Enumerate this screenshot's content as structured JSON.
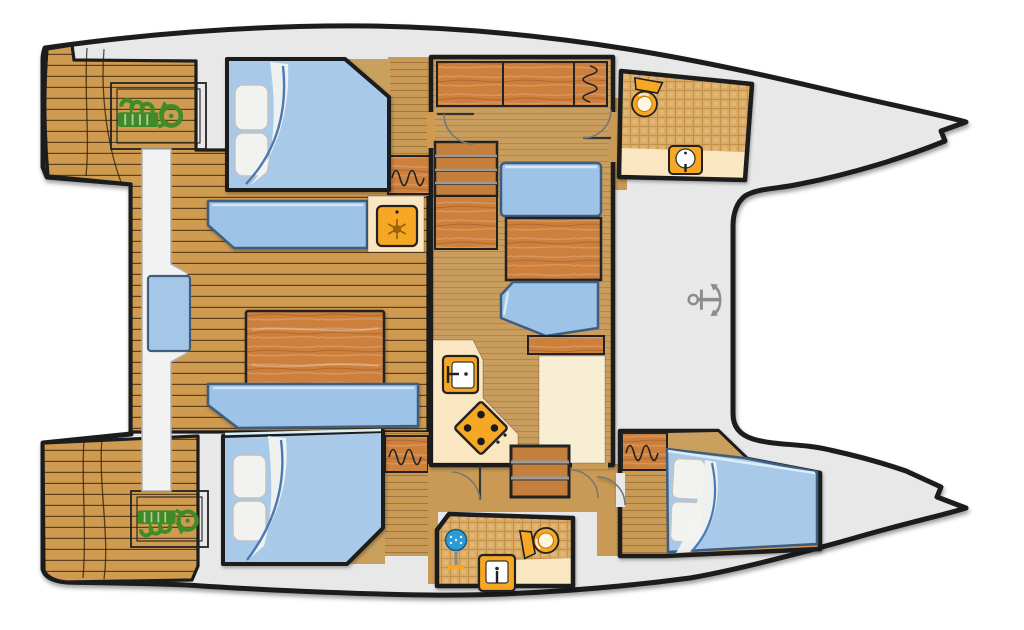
{
  "title": "Catamaran yacht deck floor plan",
  "colors": {
    "page_bg": "#ffffff",
    "hull_fill": "#e8e8e8",
    "outline": "#1c1c1c",
    "deck_wood": "#cf9b51",
    "deck_line": "#4a3110",
    "floor_wood": "#c99a55",
    "floor_plain": "#c89a55",
    "salon_wood": "#c99d5e",
    "cabinet_wood": "#cd7f3c",
    "step_wood": "#c57f3d",
    "bed_blue": "#a9c9e9",
    "bed_edge": "#3f5e7e",
    "bed_highlight": "#d8effa",
    "bench_blue": "#9dc3e8",
    "cushion_blue": "#a5c6e7",
    "pillow_white": "#f2f2f0",
    "sheet_blue": "#4a7ab5",
    "cream": "#fae7c1",
    "cream_light": "#f8eed3",
    "tile_base": "#dcab63",
    "tile_line": "#bb8a45",
    "icon_orange": "#f6a723",
    "icon_orange_dark": "#b87708",
    "icon_outline": "#222222",
    "engine_green": "#3f8b28",
    "shower_blue": "#2d9bd5",
    "anchor_gray": "#8c8c8c",
    "white_bench": "#f2f2f2"
  },
  "regions": {
    "boat": {
      "label": "Catamaran floor plan, bows pointing right"
    },
    "aft_deck_top": {
      "label": "Aft deck platform with engine hatch (top hull)"
    },
    "aft_deck_bottom": {
      "label": "Aft deck platform with engine hatch (bottom hull)"
    },
    "cockpit": {
      "label": "Cockpit with table and bench seating"
    },
    "transom_bench": {
      "label": "Cockpit bench with seat cushion"
    },
    "cabin_aft_top": {
      "label": "Aft double berth cabin, top hull"
    },
    "cabin_aft_bottom": {
      "label": "Aft double berth cabin, bottom hull"
    },
    "cabin_forward_bottom": {
      "label": "Forward double berth cabin, bottom hull"
    },
    "salon": {
      "label": "Salon with galley, dinette and companionway steps"
    },
    "galley": {
      "label": "Galley with sink, stove and refrigerator"
    },
    "dinette": {
      "label": "Dinette with table and facing seats"
    },
    "bathroom_top": {
      "label": "Forward bathroom with toilet and washbasin, top hull"
    },
    "bathroom_bottom": {
      "label": "Bathroom with shower, toilet and washbasin, bottom hull"
    },
    "foredeck": {
      "label": "Foredeck between hulls with anchor"
    }
  },
  "icons": {
    "engine_top": "engine-hatch",
    "engine_bottom": "engine-hatch",
    "refrigerator": "refrigerator-snowflake",
    "galley_sink": "sink-with-faucet",
    "stove": "four-burner-stove",
    "toilet_top": "toilet",
    "basin_top": "washbasin",
    "shower": "shower-head",
    "toilet_bottom": "toilet",
    "basin_bottom": "washbasin",
    "anchor": "anchor",
    "wardrobe": "hanging-locker-squiggle"
  }
}
